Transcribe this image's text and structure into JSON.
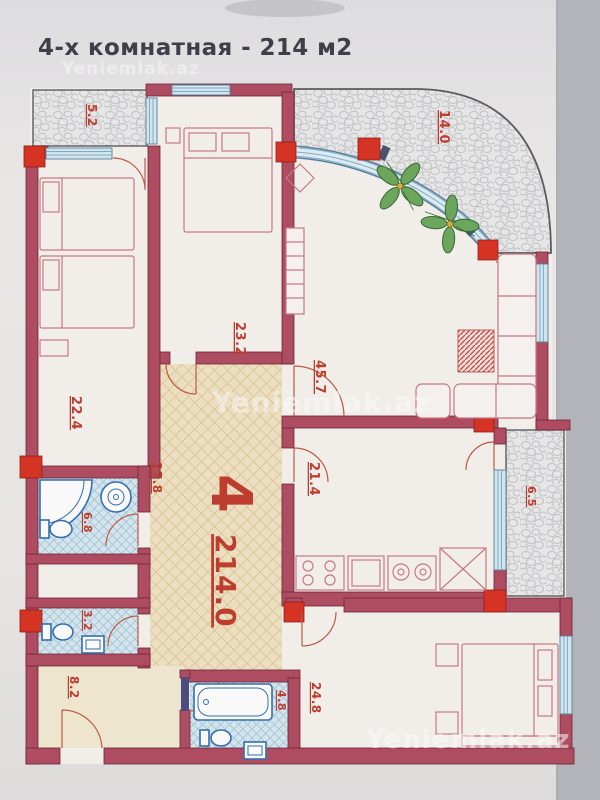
{
  "title": "4-х комнатная - 214 м2",
  "watermark": {
    "text": "Yeniemlak.az"
  },
  "plan": {
    "rooms_count": "4",
    "total_area": "214.0",
    "areas": {
      "balcony_top_left": "5.2",
      "balcony_top_right": "14.0",
      "bedroom_left": "22.4",
      "bedroom_middle": "23.2",
      "living_room": "45.7",
      "hall": "27.8",
      "bathroom": "6.8",
      "wc": "3.2",
      "entry": "8.2",
      "kitchen": "21.4",
      "balcony_right": "6.5",
      "bedroom_bottom": "24.8",
      "bathroom_bottom": "4.8"
    }
  }
}
